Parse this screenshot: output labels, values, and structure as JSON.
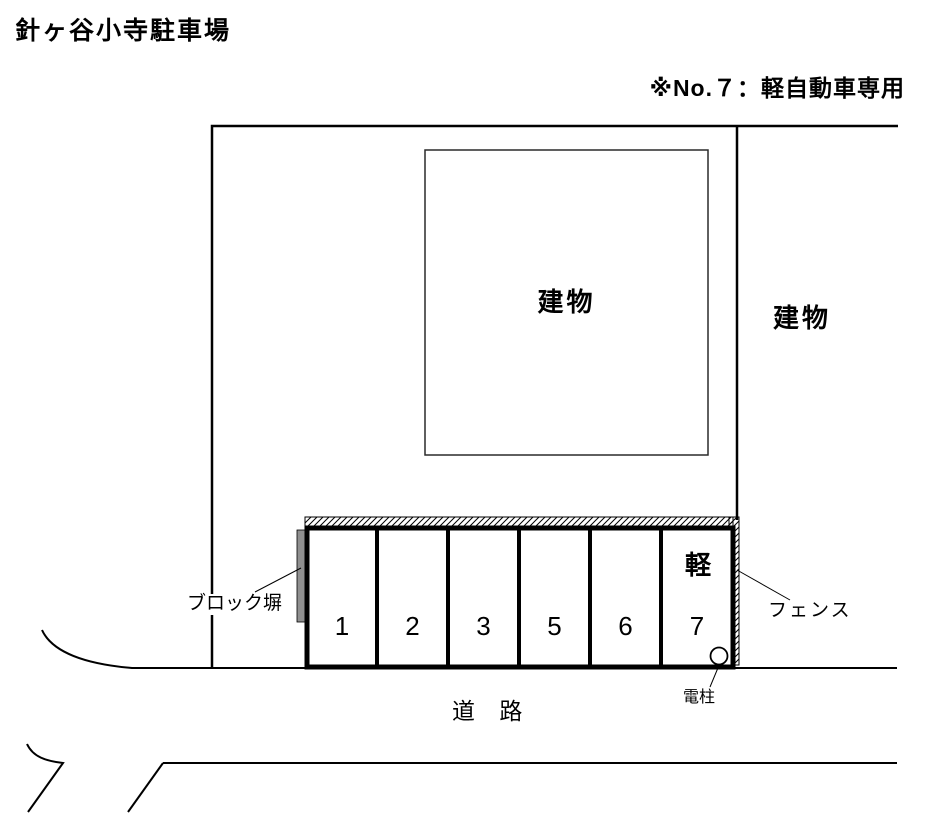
{
  "title": "針ヶ谷小寺駐車場",
  "note": "※No.７：軽自動車専用",
  "diagram": {
    "building_label": "建物",
    "building_right_label": "建物",
    "block_wall_label": "ブロック塀",
    "fence_label": "フェンス",
    "pole_label": "電柱",
    "road_label": "道 路",
    "stalls": [
      {
        "number": "1"
      },
      {
        "number": "2"
      },
      {
        "number": "3"
      },
      {
        "number": "5"
      },
      {
        "number": "6"
      },
      {
        "number": "7",
        "tag": "軽"
      }
    ]
  },
  "colors": {
    "line": "#000000",
    "wall_gray": "#8f8f8f",
    "background": "#ffffff"
  }
}
